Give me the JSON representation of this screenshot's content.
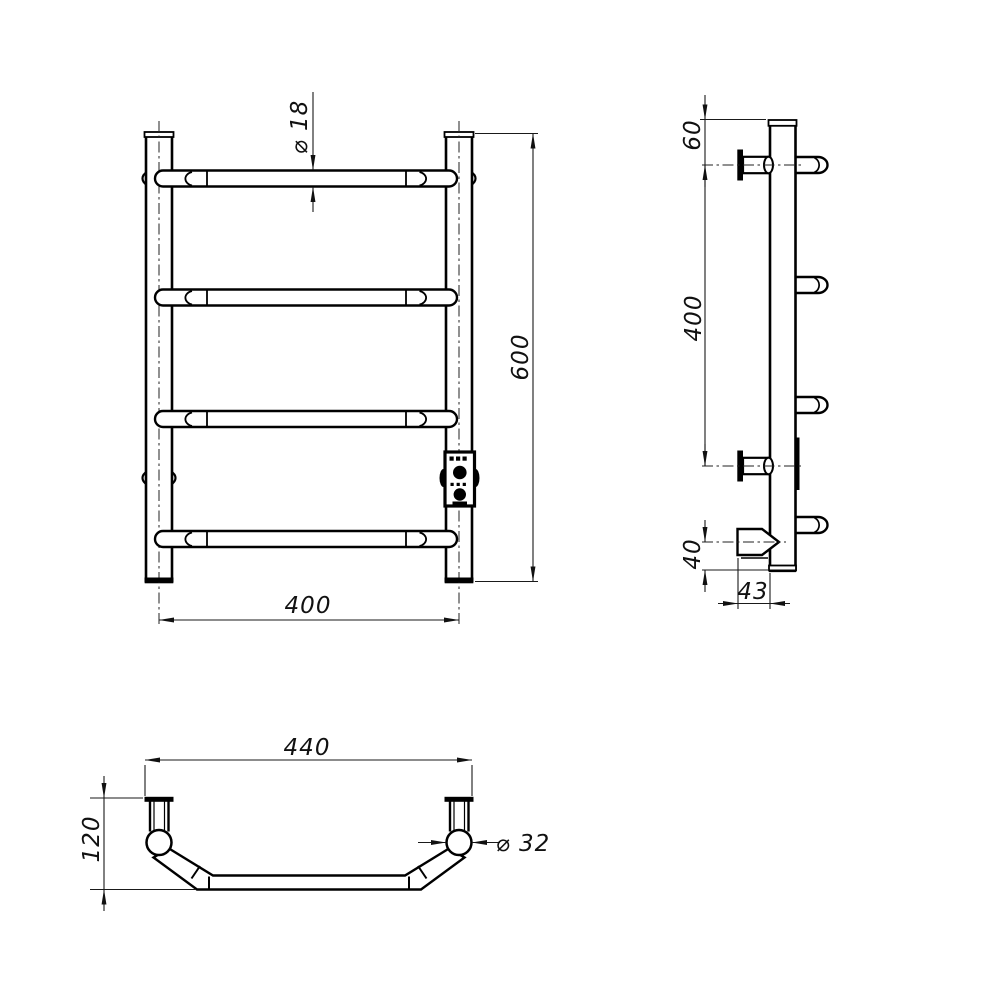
{
  "colors": {
    "line": "#000000",
    "background": "#ffffff"
  },
  "front_view": {
    "labels": {
      "bar_diameter": "⌀ 18",
      "height": "600",
      "width": "400"
    }
  },
  "side_view": {
    "labels": {
      "top_offset": "60",
      "bracket_span": "400",
      "bottom_offset": "40",
      "bracket_depth": "43"
    }
  },
  "plan_view": {
    "labels": {
      "overall_width": "440",
      "depth": "120",
      "post_diameter": "⌀ 32"
    }
  }
}
